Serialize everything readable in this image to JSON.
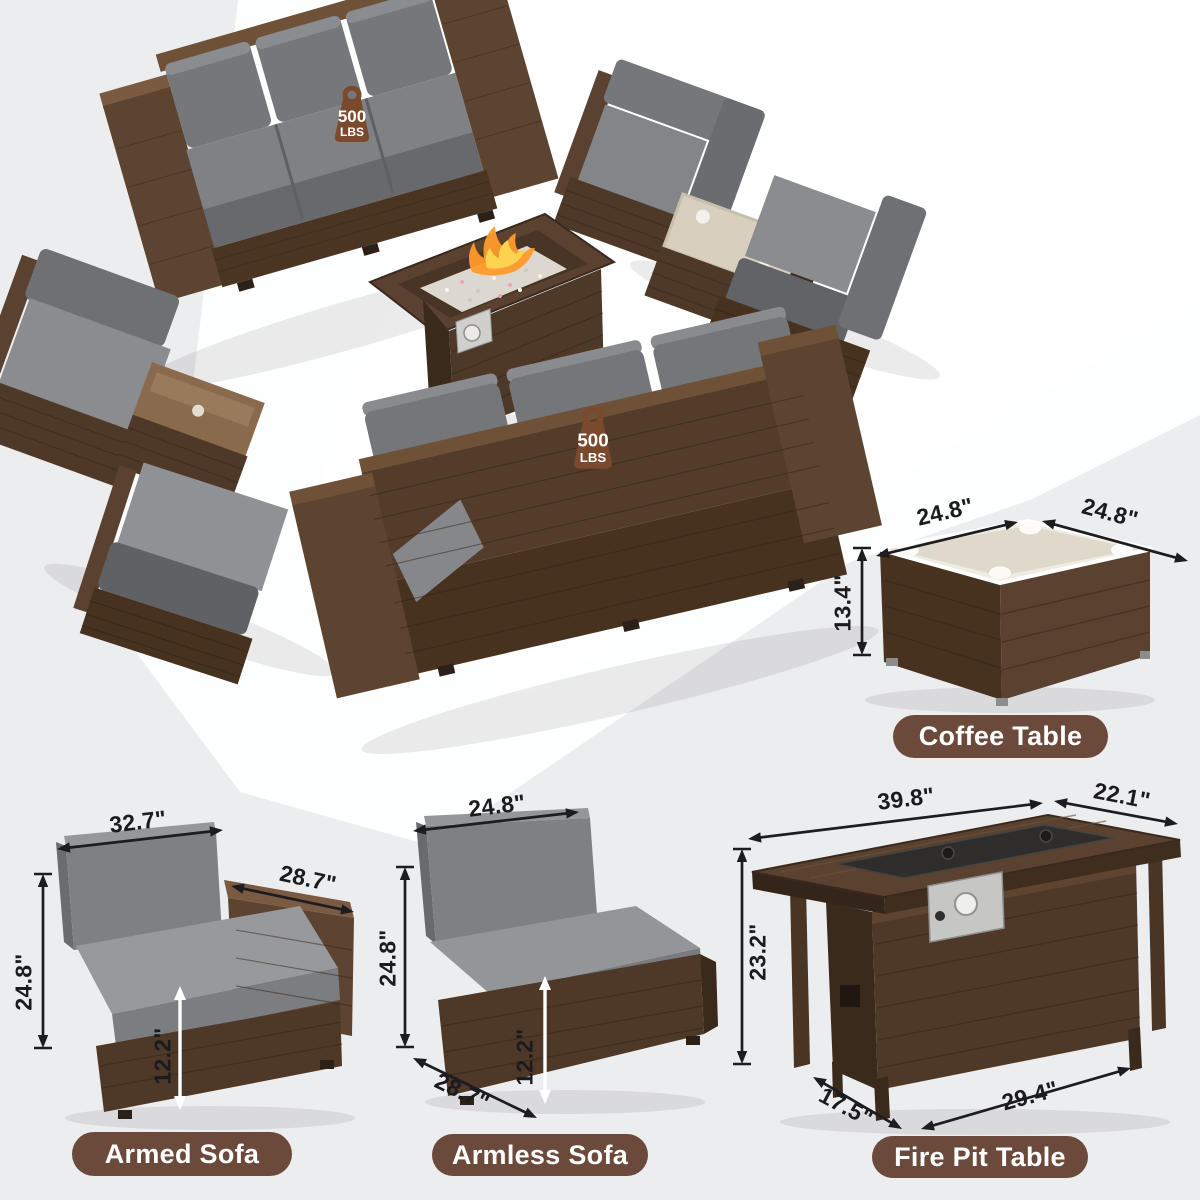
{
  "weight_badges": [
    {
      "value": "500",
      "unit": "LBS"
    },
    {
      "value": "500",
      "unit": "LBS"
    }
  ],
  "sections": {
    "coffee_table": {
      "label": "Coffee Table",
      "dims": {
        "top_width": "24.8\"",
        "top_depth": "24.8\"",
        "height": "13.4\""
      }
    },
    "armed_sofa": {
      "label": "Armed Sofa",
      "dims": {
        "width": "32.7\"",
        "arm_depth": "28.7\"",
        "height": "24.8\"",
        "seat_height": "12.2\""
      }
    },
    "armless_sofa": {
      "label": "Armless Sofa",
      "dims": {
        "width": "24.8\"",
        "height": "24.8\"",
        "seat_height": "12.2\"",
        "depth": "28.7\""
      }
    },
    "fire_pit_table": {
      "label": "Fire Pit Table",
      "dims": {
        "top_width": "39.8\"",
        "top_depth": "22.1\"",
        "height": "23.2\"",
        "base_depth": "17.5\"",
        "base_width": "29.4\""
      }
    }
  },
  "colors": {
    "pill_brown": "#6B4A3B",
    "badge_brown": "#7B4A2C",
    "wicker_dark": "#46321F",
    "wicker": "#5A4130",
    "wicker_light": "#7A5A40",
    "cushion_gray": "#797B7E",
    "glass": "#E5E0D4",
    "flame_orange": "#FF9A2A",
    "flame_yellow": "#FFD34F",
    "background_gray": "#ECEDEF",
    "dim_line": "#1D1D1F"
  }
}
